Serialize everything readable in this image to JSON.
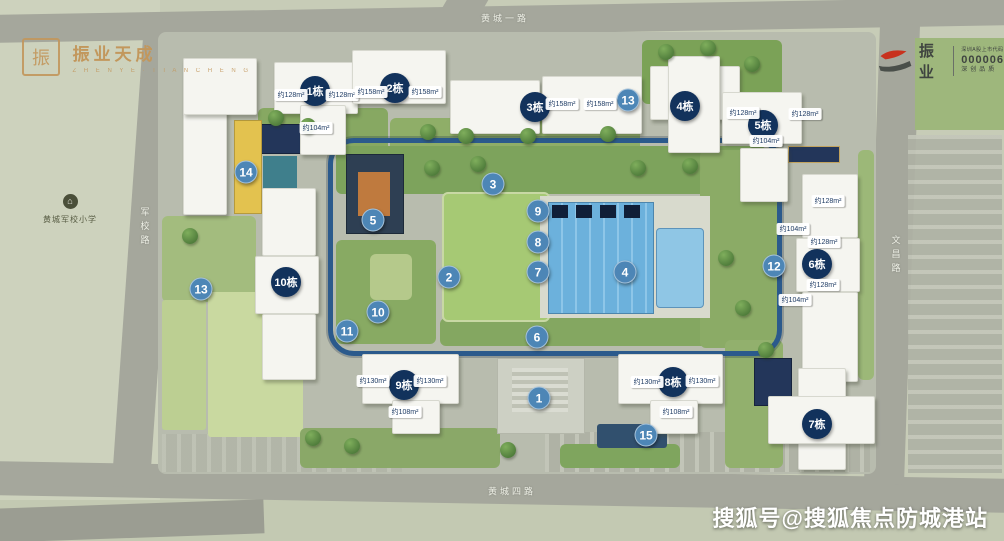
{
  "branding": {
    "logo_left": {
      "seal": "振",
      "name": "振业天成",
      "subtitle": "Z H E N Y E · T I A N C H E N G"
    },
    "logo_right": {
      "name": "振业",
      "stock_label": "深圳A股上市代码",
      "stock_code": "000006",
      "tagline": "深创品质"
    }
  },
  "watermark": "搜狐号@搜狐焦点防城港站",
  "school": {
    "label": "黄城军校小学",
    "icon": "school-icon"
  },
  "roads": {
    "top": "黄城一路",
    "bottom": "黄城四路",
    "left": "军校路",
    "right": "文昌路"
  },
  "colors": {
    "ground": "#c7ccb7",
    "road": "#a5a79c",
    "building_marker": "#12325c",
    "spot_marker": "#4d86b6",
    "loop": "#2b5a8c",
    "pool": "#6cb1dc",
    "lawn": "#a6c974",
    "gold": "#c2975c",
    "logo_red": "#c8321e"
  },
  "markers": {
    "buildings": [
      {
        "label": "1栋",
        "x": 315,
        "y": 91
      },
      {
        "label": "2栋",
        "x": 395,
        "y": 88
      },
      {
        "label": "3栋",
        "x": 535,
        "y": 107
      },
      {
        "label": "4栋",
        "x": 685,
        "y": 106
      },
      {
        "label": "5栋",
        "x": 763,
        "y": 125
      },
      {
        "label": "6栋",
        "x": 817,
        "y": 264
      },
      {
        "label": "7栋",
        "x": 817,
        "y": 424
      },
      {
        "label": "8栋",
        "x": 673,
        "y": 382
      },
      {
        "label": "9栋",
        "x": 404,
        "y": 385
      },
      {
        "label": "10栋",
        "x": 286,
        "y": 282
      }
    ],
    "spots": [
      {
        "label": "1",
        "x": 539,
        "y": 398
      },
      {
        "label": "2",
        "x": 449,
        "y": 277
      },
      {
        "label": "3",
        "x": 493,
        "y": 184
      },
      {
        "label": "4",
        "x": 625,
        "y": 272
      },
      {
        "label": "5",
        "x": 373,
        "y": 220
      },
      {
        "label": "6",
        "x": 537,
        "y": 337
      },
      {
        "label": "7",
        "x": 538,
        "y": 272
      },
      {
        "label": "8",
        "x": 538,
        "y": 242
      },
      {
        "label": "9",
        "x": 538,
        "y": 211
      },
      {
        "label": "10",
        "x": 378,
        "y": 312
      },
      {
        "label": "11",
        "x": 347,
        "y": 331
      },
      {
        "label": "12",
        "x": 774,
        "y": 266
      },
      {
        "label": "13",
        "x": 201,
        "y": 289
      },
      {
        "label": "13",
        "x": 628,
        "y": 100
      },
      {
        "label": "14",
        "x": 246,
        "y": 172
      },
      {
        "label": "15",
        "x": 646,
        "y": 435
      }
    ]
  },
  "area_labels": [
    {
      "text": "约128m²",
      "x": 291,
      "y": 95
    },
    {
      "text": "约128m²",
      "x": 342,
      "y": 95
    },
    {
      "text": "约104m²",
      "x": 316,
      "y": 128
    },
    {
      "text": "约158m²",
      "x": 371,
      "y": 92
    },
    {
      "text": "约158m²",
      "x": 425,
      "y": 92
    },
    {
      "text": "约158m²",
      "x": 562,
      "y": 104
    },
    {
      "text": "约158m²",
      "x": 600,
      "y": 104
    },
    {
      "text": "约128m²",
      "x": 743,
      "y": 113
    },
    {
      "text": "约128m²",
      "x": 805,
      "y": 114
    },
    {
      "text": "约104m²",
      "x": 766,
      "y": 141
    },
    {
      "text": "约128m²",
      "x": 828,
      "y": 201
    },
    {
      "text": "约104m²",
      "x": 793,
      "y": 229
    },
    {
      "text": "约128m²",
      "x": 824,
      "y": 242
    },
    {
      "text": "约128m²",
      "x": 823,
      "y": 285
    },
    {
      "text": "约104m²",
      "x": 795,
      "y": 300
    },
    {
      "text": "约130m²",
      "x": 373,
      "y": 381
    },
    {
      "text": "约130m²",
      "x": 430,
      "y": 381
    },
    {
      "text": "约108m²",
      "x": 405,
      "y": 412
    },
    {
      "text": "约130m²",
      "x": 647,
      "y": 382
    },
    {
      "text": "约130m²",
      "x": 702,
      "y": 381
    },
    {
      "text": "约108m²",
      "x": 676,
      "y": 412
    }
  ]
}
